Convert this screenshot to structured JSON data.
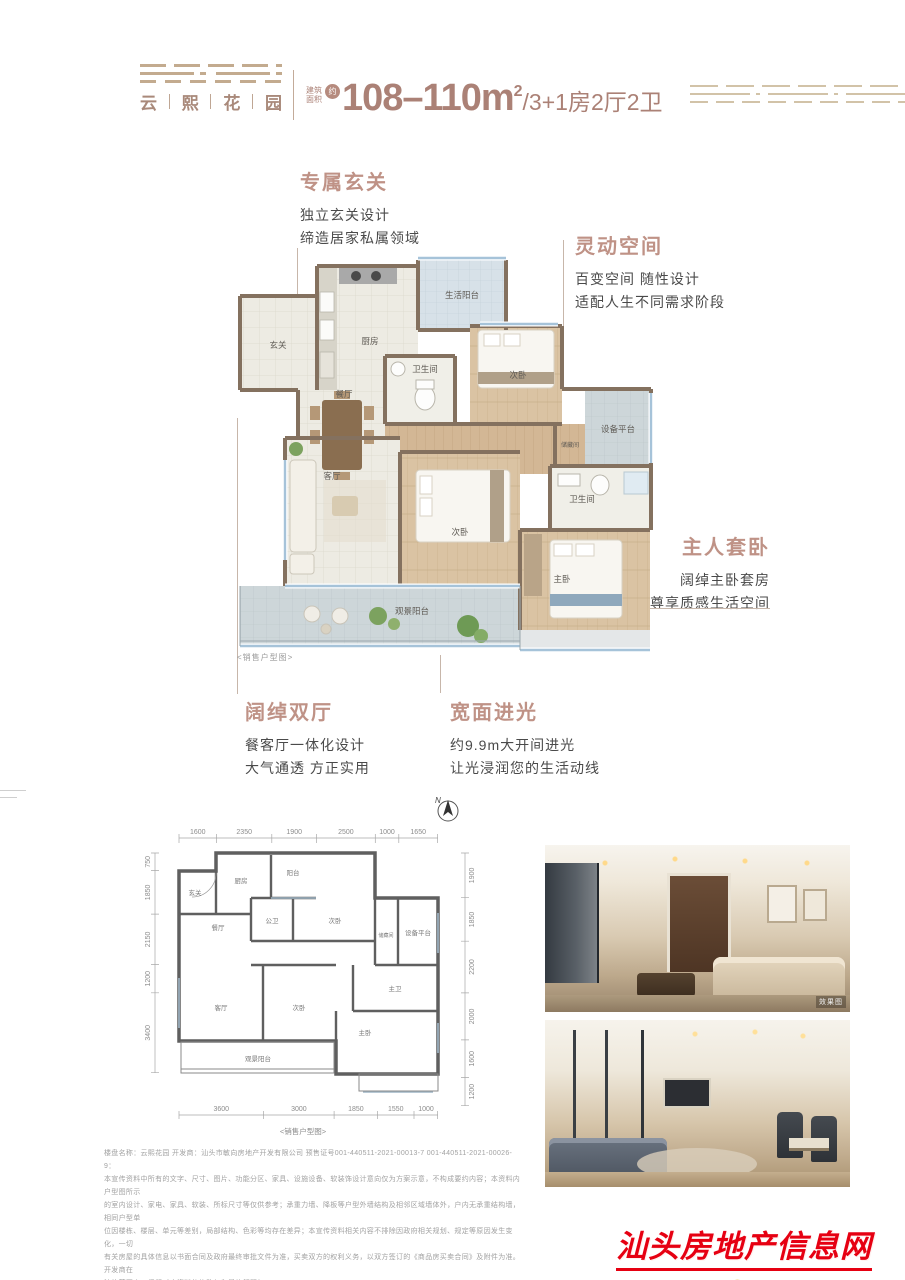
{
  "header": {
    "logo_name": "云熙花园",
    "logo_chars": [
      "云",
      "熙",
      "花",
      "园"
    ],
    "area_prefix_line1": "建筑",
    "area_prefix_line2": "面积",
    "area_circle": "约",
    "area_value": "108–110m",
    "area_sup": "2",
    "area_suffix": "/3+1房2厅2卫"
  },
  "annotations": {
    "entry": {
      "title": "专属玄关",
      "line1": "独立玄关设计",
      "line2": "缔造居家私属领域"
    },
    "flex": {
      "title": "灵动空间",
      "line1": "百变空间 随性设计",
      "line2": "适配人生不同需求阶段"
    },
    "master": {
      "title": "主人套卧",
      "line1": "阔绰主卧套房",
      "line2": "尊享质感生活空间"
    },
    "halls": {
      "title": "阔绰双厅",
      "line1": "餐客厅一体化设计",
      "line2": "大气通透 方正实用"
    },
    "light": {
      "title": "宽面进光",
      "line1": "约9.9m大开间进光",
      "line2": "让光浸润您的生活动线"
    }
  },
  "main_plan": {
    "caption": "<销售户型图>",
    "rooms": {
      "xuanguan": "玄关",
      "chufang": "厨房",
      "shenghuoyangtai": "生活阳台",
      "canting": "餐厅",
      "weishengjian1": "卫生间",
      "ciwo1": "次卧",
      "shebeipingtai": "设备平台",
      "chucangjian": "储藏间",
      "keting": "客厅",
      "ciwo2": "次卧",
      "weishengjian2": "卫生间",
      "zhuwo": "主卧",
      "guanjingyangtai": "观景阳台"
    }
  },
  "lower_plan": {
    "north_label": "N",
    "caption": "<销售户型图>",
    "top_dims": [
      "1600",
      "2350",
      "1900",
      "2500",
      "1000",
      "1650"
    ],
    "left_dims": [
      "750",
      "1850",
      "2150",
      "1200",
      "3400"
    ],
    "right_dims": [
      "1900",
      "1850",
      "2200",
      "2000",
      "1600",
      "1200"
    ],
    "bottom_dims": [
      "3600",
      "3000",
      "1850",
      "1550",
      "1000"
    ],
    "rooms": {
      "xuanguan": "玄关",
      "chufang": "厨房",
      "yangtai": "阳台",
      "canting": "餐厅",
      "gongwei": "公卫",
      "ciwo1": "次卧",
      "chucangjian": "储藏间",
      "shebeipingtai": "设备平台",
      "zhuwei": "主卫",
      "keting": "客厅",
      "ciwo2": "次卧",
      "zhuwo": "主卧",
      "guanjingyangtai": "观景阳台"
    }
  },
  "photos": {
    "photo1_caption": "效果图"
  },
  "disclaimer": {
    "lines": [
      "楼盘名称：云熙花园 开发商：汕头市敏向房地产开发有限公司 预售证号001-440511-2021-00013-7 001-440511-2021-00026-9：",
      "本宣传资料中所有的文字、尺寸、图片、功能分区、家具、设施设备、软装饰设计意向仅为方案示意，不构成要约内容；本资料内户型图所示",
      "的室内设计、家电、家具、软装、所标尺寸等仅供参考；承重力墙、降板等户型外墙结构及相邻区域墙体外，户内无承重结构墙，相同户型单",
      "位因楼栋、楼层、单元等差别，局部结构、色彩等均存在差异；本宣传资料相关内容不排除因政府相关规划、规定等原因发生变化，一切",
      "有关房屋的具体信息以书面合同及政府最终审批文件为准，买卖双方的权利义务，以双方签订的《商品房买卖合同》及附件为准。开发商在",
      "法律范围内，保留对本资料的修改权和最终解释权。"
    ]
  },
  "watermark": {
    "site_name": "汕头房地产信息网",
    "url_p1": "WWW.",
    "url_p2": "STRE",
    "url_p3": ".NET"
  }
}
